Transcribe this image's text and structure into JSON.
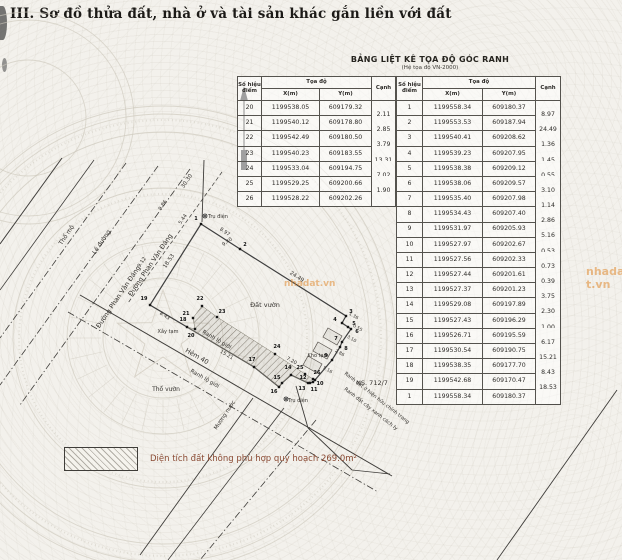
{
  "page": {
    "title": "III. Sơ đồ thửa đất, nhà ở và tài sản khác gắn liền với đất"
  },
  "table": {
    "title": "BẢNG LIỆT KÊ TỌA ĐỘ GÓC RANH",
    "subtitle": "(Hệ tọa độ VN-2000)",
    "headers": {
      "point": "Số hiệu điểm",
      "coord": "Tọa độ",
      "x": "X(m)",
      "y": "Y(m)",
      "edge": "Cạnh"
    },
    "left_rows": [
      {
        "p": "20",
        "x": "1199538.05",
        "y": "609179.32",
        "e": "2.11"
      },
      {
        "p": "21",
        "x": "1199540.12",
        "y": "609178.80",
        "e": "2.85"
      },
      {
        "p": "22",
        "x": "1199542.49",
        "y": "609180.50",
        "e": "3.79"
      },
      {
        "p": "23",
        "x": "1199540.23",
        "y": "609183.55",
        "e": "13.31"
      },
      {
        "p": "24",
        "x": "1199533.04",
        "y": "609194.75",
        "e": "7.02"
      },
      {
        "p": "25",
        "x": "1199529.25",
        "y": "609200.66",
        "e": "1.90"
      },
      {
        "p": "26",
        "x": "1199528.22",
        "y": "609202.26",
        "e": ""
      }
    ],
    "right_rows": [
      {
        "p": "1",
        "x": "1199558.34",
        "y": "609180.37",
        "e": "8.97"
      },
      {
        "p": "2",
        "x": "1199553.53",
        "y": "609187.94",
        "e": "24.49"
      },
      {
        "p": "3",
        "x": "1199540.41",
        "y": "609208.62",
        "e": "1.36"
      },
      {
        "p": "4",
        "x": "1199539.23",
        "y": "609207.95",
        "e": "1.45"
      },
      {
        "p": "5",
        "x": "1199538.38",
        "y": "609209.12",
        "e": "0.55"
      },
      {
        "p": "6",
        "x": "1199538.06",
        "y": "609209.57",
        "e": "3.10"
      },
      {
        "p": "7",
        "x": "1199535.40",
        "y": "609207.98",
        "e": "1.14"
      },
      {
        "p": "8",
        "x": "1199534.43",
        "y": "609207.40",
        "e": "2.86"
      },
      {
        "p": "9",
        "x": "1199531.97",
        "y": "609205.93",
        "e": "5.16"
      },
      {
        "p": "10",
        "x": "1199527.97",
        "y": "609202.67",
        "e": "0.53"
      },
      {
        "p": "11",
        "x": "1199527.56",
        "y": "609202.33",
        "e": "0.73"
      },
      {
        "p": "12",
        "x": "1199527.44",
        "y": "609201.61",
        "e": "0.39"
      },
      {
        "p": "13",
        "x": "1199527.37",
        "y": "609201.23",
        "e": "3.75"
      },
      {
        "p": "14",
        "x": "1199529.08",
        "y": "609197.89",
        "e": "2.30"
      },
      {
        "p": "15",
        "x": "1199527.43",
        "y": "609196.29",
        "e": "1.00"
      },
      {
        "p": "16",
        "x": "1199526.71",
        "y": "609195.59",
        "e": "6.17"
      },
      {
        "p": "17",
        "x": "1199530.54",
        "y": "609190.75",
        "e": "15.21"
      },
      {
        "p": "18",
        "x": "1199538.35",
        "y": "609177.70",
        "e": "8.43"
      },
      {
        "p": "19",
        "x": "1199542.68",
        "y": "609170.47",
        "e": "18.53"
      },
      {
        "p": "1",
        "x": "1199558.34",
        "y": "609180.37",
        "e": ""
      }
    ]
  },
  "legend": {
    "text": "Diện tích đất không phù hợp quy hoạch 269.0m²"
  },
  "watermark": {
    "text": "nhadat.vn",
    "color": "#e08a30"
  },
  "map": {
    "emblems": [
      {
        "cx": 163,
        "cy": 338,
        "rings": [
          232,
          224,
          206,
          150,
          96,
          60
        ],
        "dot_rings": [
          218,
          144
        ],
        "spokes": {
          "r1": 62,
          "r2": 95,
          "count": 28
        },
        "star": "163,290 174.2,322.6 208.6,323.2 181.1,343.9 191.2,376.8 163,357 134.8,376.8 144.9,343.9 117.4,323.2 151.8,322.6"
      },
      {
        "cx": 28,
        "cy": 118,
        "rings": [
          106,
          98,
          58
        ],
        "dot_rings": [],
        "spokes": null,
        "star": null
      }
    ],
    "lines": [
      {
        "x1": 62,
        "y1": 158,
        "x2": 0,
        "y2": 244,
        "style": "solid",
        "w": 1,
        "name": "road-edge-line"
      },
      {
        "x1": 94,
        "y1": 160,
        "x2": 0,
        "y2": 290,
        "style": "solid",
        "w": 0.8,
        "name": "road-edge-line"
      },
      {
        "x1": 126,
        "y1": 163,
        "x2": 0,
        "y2": 338,
        "style": "dashdot",
        "w": 0.8,
        "name": "road-boundary-line"
      },
      {
        "x1": 158,
        "y1": 166,
        "x2": 0,
        "y2": 385,
        "style": "dashdot",
        "w": 0.8,
        "name": "road-boundary-line"
      },
      {
        "x1": 190,
        "y1": 169,
        "x2": 20,
        "y2": 405,
        "style": "dashdot",
        "w": 0.8,
        "name": "road-boundary-line"
      },
      {
        "x1": 222,
        "y1": 172,
        "x2": 128,
        "y2": 303,
        "style": "dash",
        "w": 0.7,
        "name": "setback-line"
      },
      {
        "x1": 253,
        "y1": 398,
        "x2": 140,
        "y2": 555,
        "style": "solid",
        "w": 0.9,
        "name": "ditch-line"
      },
      {
        "x1": 284,
        "y1": 408,
        "x2": 168,
        "y2": 560,
        "style": "solid",
        "w": 0.8,
        "name": "ditch-line"
      },
      {
        "x1": 316,
        "y1": 420,
        "x2": 200,
        "y2": 560,
        "style": "dashdot",
        "w": 0.8,
        "name": "ditch-line"
      },
      {
        "x1": 80,
        "y1": 295,
        "x2": 392,
        "y2": 476,
        "style": "solid",
        "w": 1,
        "name": "alley-line"
      },
      {
        "x1": 68,
        "y1": 312,
        "x2": 378,
        "y2": 492,
        "style": "dashdot",
        "w": 0.8,
        "name": "corridor-boundary-line"
      },
      {
        "x1": 617,
        "y1": 390,
        "x2": 497,
        "y2": 560,
        "style": "solid",
        "w": 0.9,
        "name": "boundary-line"
      },
      {
        "x1": 296,
        "y1": 386,
        "x2": 308,
        "y2": 428,
        "style": "solid",
        "w": 0.9,
        "name": "boundary-line"
      },
      {
        "x1": 308,
        "y1": 428,
        "x2": 352,
        "y2": 470,
        "style": "solid",
        "w": 0.9,
        "name": "boundary-line"
      },
      {
        "x1": 352,
        "y1": 470,
        "x2": 390,
        "y2": 474,
        "style": "solid",
        "w": 0.8,
        "name": "boundary-line"
      },
      {
        "x1": 204,
        "y1": 160,
        "x2": 202,
        "y2": 222,
        "style": "solid",
        "w": 0.9,
        "name": "leader-line"
      },
      {
        "x1": 244,
        "y1": 96,
        "x2": 244,
        "y2": 168,
        "style": "solid",
        "w": 1.3,
        "name": "north-arrow-shaft"
      }
    ],
    "polygons": [
      {
        "name": "parcel-outline",
        "pts": "201,224 240,249 346,316 342,323 348,327 351,329 342,342 340,347 332,360 315,380 313,382 310,383 308,383 291,375 282,383 279,387 254,367 187,327 150,305",
        "fill": "none",
        "stroke": "#3e3e3e",
        "w": 1.2
      },
      {
        "name": "planning-strip",
        "pts": "202,306 217,317 275,354 305,374 313,379 308,383 291,375 282,383 279,387 254,367 187,327 195,329 193,318",
        "fill": "url(#hatch)",
        "stroke": "#7a7668",
        "w": 0.5
      },
      {
        "name": "house",
        "pts": "328,328 342,336 337,345 323,337",
        "fill": "rgba(90,85,75,0.08)",
        "stroke": "#55504a",
        "w": 0.7
      },
      {
        "name": "house",
        "pts": "318,342 332,350 327,359 313,351",
        "fill": "rgba(90,85,75,0.08)",
        "stroke": "#55504a",
        "w": 0.7
      },
      {
        "name": "house",
        "pts": "308,356 322,364 317,373 303,365",
        "fill": "rgba(90,85,75,0.08)",
        "stroke": "#55504a",
        "w": 0.7
      },
      {
        "name": "north-arrow-head",
        "pts": "244,86 240,101 248,101",
        "fill": "#2b2b2b",
        "stroke": "none",
        "w": 0
      },
      {
        "name": "north-arrow-base",
        "pts": "241,150 247,150 247,170 241,170",
        "fill": "#2b2b2b",
        "stroke": "none",
        "w": 0
      }
    ],
    "points": [
      {
        "n": "1",
        "x": 201,
        "y": 224,
        "lx": 196,
        "ly": 220
      },
      {
        "n": "2",
        "x": 240,
        "y": 249,
        "lx": 245,
        "ly": 246
      },
      {
        "n": "3",
        "x": 346,
        "y": 316,
        "lx": 351,
        "ly": 313
      },
      {
        "n": "4",
        "x": 342,
        "y": 323,
        "lx": 335,
        "ly": 321
      },
      {
        "n": "5",
        "x": 348,
        "y": 327,
        "lx": 354,
        "ly": 325
      },
      {
        "n": "6",
        "x": 351,
        "y": 329,
        "lx": 357,
        "ly": 333
      },
      {
        "n": "7",
        "x": 342,
        "y": 342,
        "lx": 336,
        "ly": 340
      },
      {
        "n": "8",
        "x": 340,
        "y": 347,
        "lx": 346,
        "ly": 350
      },
      {
        "n": "9",
        "x": 332,
        "y": 360,
        "lx": 326,
        "ly": 357
      },
      {
        "n": "10",
        "x": 315,
        "y": 380,
        "lx": 320,
        "ly": 385
      },
      {
        "n": "11",
        "x": 313,
        "y": 382,
        "lx": 314,
        "ly": 391
      },
      {
        "n": "12",
        "x": 310,
        "y": 383,
        "lx": 303,
        "ly": 379
      },
      {
        "n": "13",
        "x": 308,
        "y": 383,
        "lx": 302,
        "ly": 390
      },
      {
        "n": "14",
        "x": 291,
        "y": 375,
        "lx": 288,
        "ly": 369
      },
      {
        "n": "15",
        "x": 282,
        "y": 383,
        "lx": 277,
        "ly": 379
      },
      {
        "n": "16",
        "x": 279,
        "y": 387,
        "lx": 274,
        "ly": 393
      },
      {
        "n": "17",
        "x": 254,
        "y": 367,
        "lx": 252,
        "ly": 361
      },
      {
        "n": "18",
        "x": 187,
        "y": 327,
        "lx": 183,
        "ly": 321
      },
      {
        "n": "19",
        "x": 150,
        "y": 305,
        "lx": 144,
        "ly": 300
      },
      {
        "n": "20",
        "x": 195,
        "y": 329,
        "lx": 191,
        "ly": 337
      },
      {
        "n": "21",
        "x": 193,
        "y": 318,
        "lx": 186,
        "ly": 315
      },
      {
        "n": "22",
        "x": 202,
        "y": 306,
        "lx": 200,
        "ly": 300
      },
      {
        "n": "23",
        "x": 217,
        "y": 317,
        "lx": 222,
        "ly": 313
      },
      {
        "n": "24",
        "x": 275,
        "y": 354,
        "lx": 277,
        "ly": 348
      },
      {
        "n": "25",
        "x": 305,
        "y": 374,
        "lx": 300,
        "ly": 369
      },
      {
        "n": "26",
        "x": 313,
        "y": 379,
        "lx": 317,
        "ly": 374
      }
    ],
    "poles": [
      {
        "x": 205,
        "y": 216
      },
      {
        "x": 286,
        "y": 399
      }
    ],
    "texts": [
      {
        "t": "Thổ mộ",
        "x": 68,
        "y": 236,
        "r": -56,
        "s": 6
      },
      {
        "t": "Lề đường",
        "x": 103,
        "y": 243,
        "r": -56,
        "s": 6
      },
      {
        "t": "Đường Phan Văn Đáng",
        "x": 120,
        "y": 298,
        "r": -56,
        "s": 6.5
      },
      {
        "t": "Đường Phan Văn Đáng",
        "x": 152,
        "y": 266,
        "r": -56,
        "s": 6.5
      },
      {
        "t": "30.30",
        "x": 188,
        "y": 182,
        "r": -56,
        "s": 5.5
      },
      {
        "t": "9.86",
        "x": 164,
        "y": 206,
        "r": -56,
        "s": 5
      },
      {
        "t": "5.44",
        "x": 184,
        "y": 220,
        "r": -56,
        "s": 5
      },
      {
        "t": "9.12",
        "x": 143,
        "y": 263,
        "r": -56,
        "s": 5
      },
      {
        "t": "9.40",
        "x": 228,
        "y": 243,
        "r": -35,
        "s": 5
      },
      {
        "t": "18.53",
        "x": 170,
        "y": 262,
        "r": -56,
        "s": 5.5
      },
      {
        "t": "8.97",
        "x": 224,
        "y": 233,
        "r": 35,
        "s": 5
      },
      {
        "t": "24.49",
        "x": 296,
        "y": 278,
        "r": 33,
        "s": 5.5
      },
      {
        "t": "Đất vườn",
        "x": 265,
        "y": 307,
        "r": 0,
        "s": 6.5
      },
      {
        "t": "Ranh lộ giới",
        "x": 216,
        "y": 341,
        "r": 30,
        "s": 5.5
      },
      {
        "t": "15.21",
        "x": 226,
        "y": 356,
        "r": 30,
        "s": 5
      },
      {
        "t": "Hẻm 40",
        "x": 196,
        "y": 358,
        "r": 30,
        "s": 6.5
      },
      {
        "t": "Ranh lộ giới",
        "x": 204,
        "y": 380,
        "r": 30,
        "s": 5.5
      },
      {
        "t": "Thổ vườn",
        "x": 166,
        "y": 391,
        "r": 0,
        "s": 6
      },
      {
        "t": "Mương nước",
        "x": 226,
        "y": 416,
        "r": -56,
        "s": 5.5
      },
      {
        "t": "Xây tạm",
        "x": 168,
        "y": 333,
        "r": 0,
        "s": 5
      },
      {
        "t": "Trụ điện",
        "x": 218,
        "y": 218,
        "r": 0,
        "s": 5
      },
      {
        "t": "Trụ điện",
        "x": 298,
        "y": 402,
        "r": 0,
        "s": 5
      },
      {
        "t": "Kho tạm",
        "x": 318,
        "y": 357,
        "r": 0,
        "s": 5
      },
      {
        "t": "7.20",
        "x": 291,
        "y": 362,
        "r": 30,
        "s": 5
      },
      {
        "t": "8.43",
        "x": 164,
        "y": 317,
        "r": 32,
        "s": 5
      },
      {
        "t": "NS. 712/7",
        "x": 372,
        "y": 385,
        "r": 0,
        "s": 6.5
      },
      {
        "t": "Ranh đất ở hiện hữu chỉnh trang",
        "x": 376,
        "y": 399,
        "r": 38,
        "s": 5
      },
      {
        "t": "Ranh đất cây xanh cách ly",
        "x": 370,
        "y": 410,
        "r": 38,
        "s": 5
      },
      {
        "t": "1.36",
        "x": 353,
        "y": 317,
        "r": 30,
        "s": 4.5
      },
      {
        "t": "0.55",
        "x": 357,
        "y": 329,
        "r": 30,
        "s": 4.5
      },
      {
        "t": "3.10",
        "x": 351,
        "y": 340,
        "r": 30,
        "s": 4.5
      },
      {
        "t": "2.86",
        "x": 339,
        "y": 354,
        "r": 30,
        "s": 4.5
      },
      {
        "t": "5.16",
        "x": 327,
        "y": 371,
        "r": 30,
        "s": 4.5
      }
    ]
  }
}
